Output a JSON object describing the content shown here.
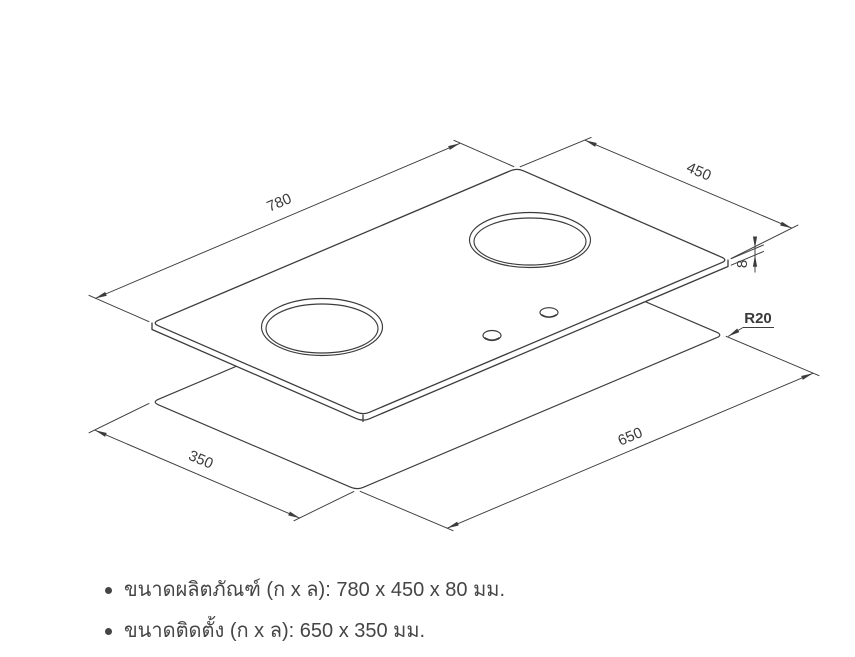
{
  "drawing": {
    "labels": {
      "width": "780",
      "depth": "450",
      "thickness": "8",
      "corner_radius": "R20",
      "cutout_length": "650",
      "cutout_width": "350"
    }
  },
  "notes": {
    "items": [
      {
        "text": "ขนาดผลิตภัณฑ์ (ก x ล): 780 x 450 x 80 มม."
      },
      {
        "text": "ขนาดติดตั้ง (ก x ล): 650 x 350 มม."
      }
    ]
  },
  "colors": {
    "line": "#3c3c3c",
    "text": "#454545"
  }
}
